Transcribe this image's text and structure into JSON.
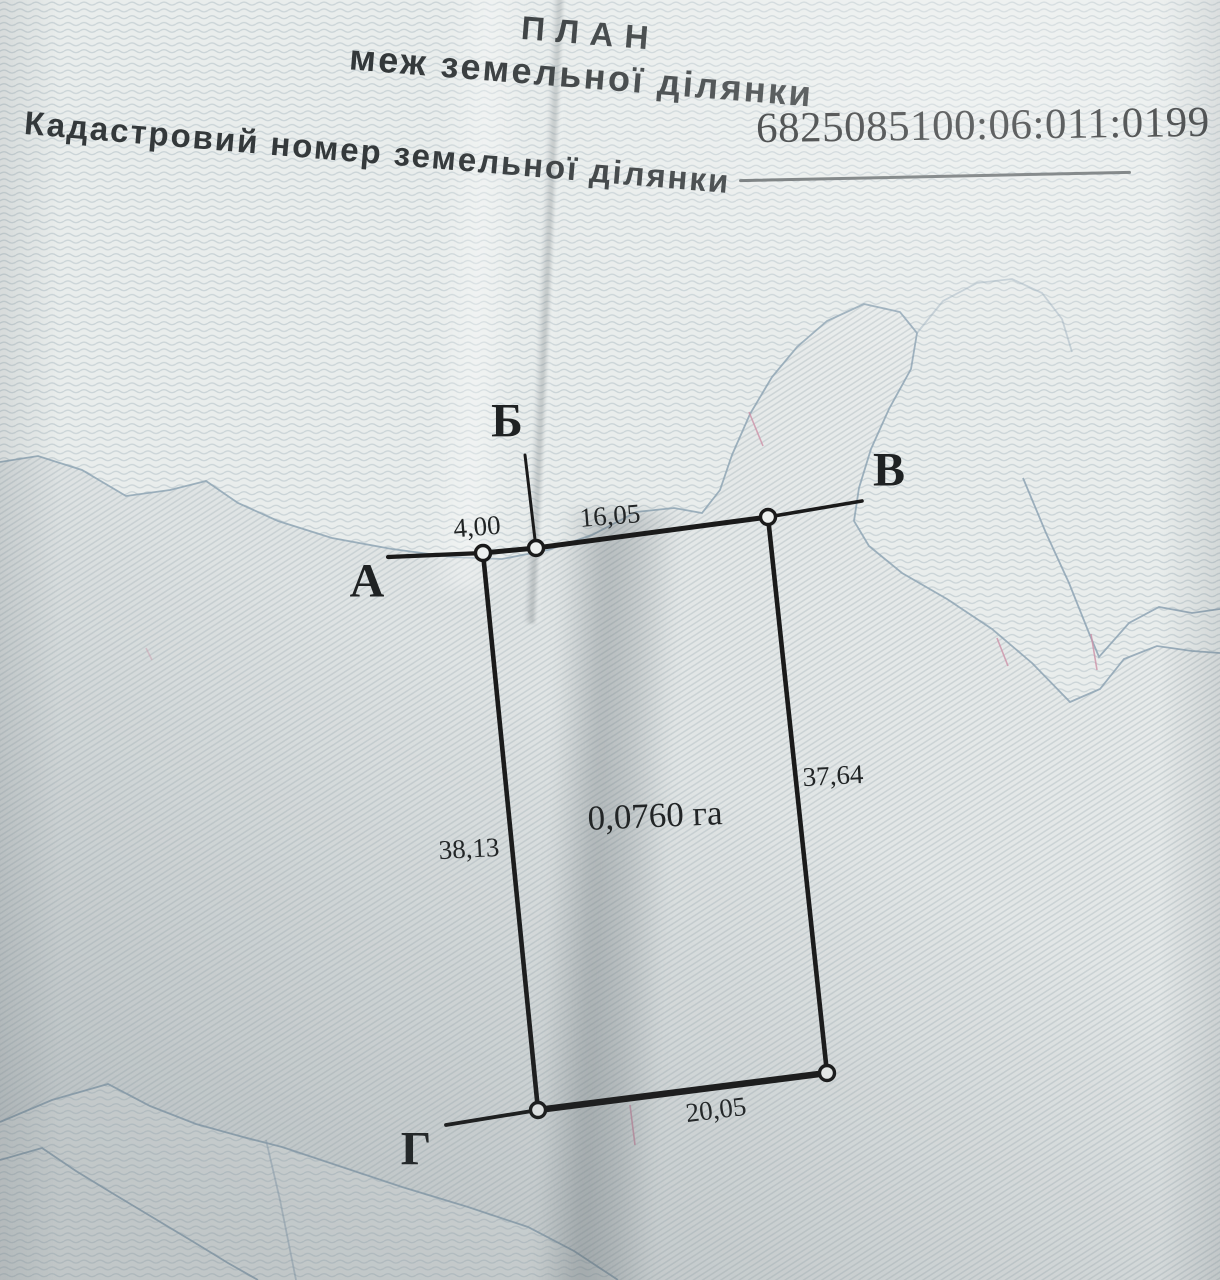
{
  "document": {
    "title_line1": "ПЛАН",
    "title_line2": "меж земельної ділянки",
    "cadastral_label": "Кадастровий номер земельної ділянки",
    "cadastral_number": "6825085100:06:011:0199"
  },
  "plan": {
    "area_label": "0,0760 га",
    "points": {
      "a": "А",
      "b": "Б",
      "v": "В",
      "g": "Г"
    },
    "measurements": {
      "a_b": "4,00",
      "b_v": "16,05",
      "v_corner": "37,64",
      "a_g": "38,13",
      "g_corner": "20,05"
    }
  }
}
